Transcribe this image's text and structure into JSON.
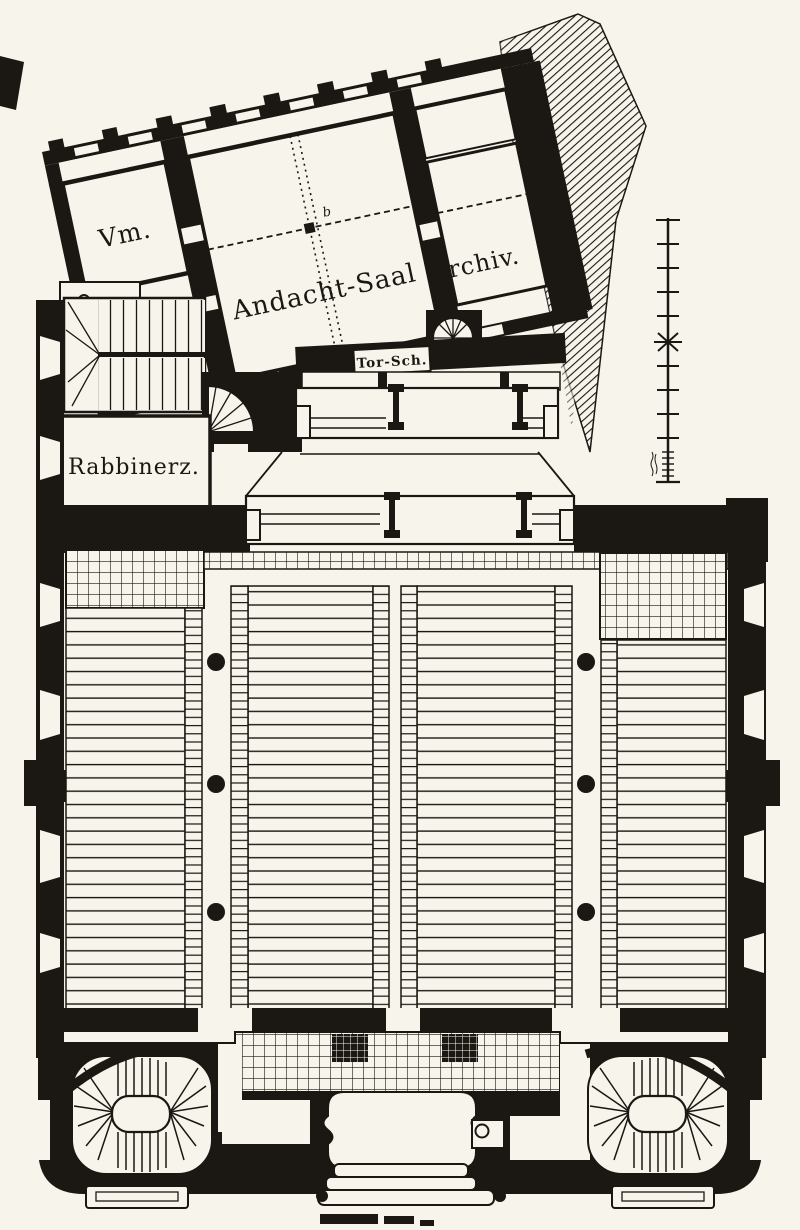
{
  "labels": {
    "vorhalle": "Vm.",
    "andacht_saal": "Andacht-Saal",
    "archiv": "Archiv.",
    "rabbinerzimmer": "Rabbinerz.",
    "tora_schrein": "Tor-Sch.",
    "beam_marker": "b"
  },
  "colors": {
    "paper": "#f7f4ec",
    "ink": "#1b1713"
  }
}
